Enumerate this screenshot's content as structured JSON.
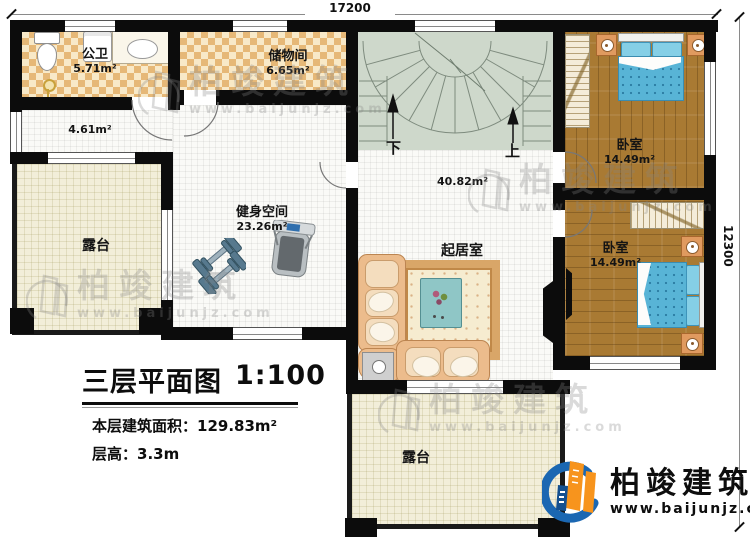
{
  "dimensions": {
    "top": "17200",
    "right": "12300"
  },
  "rooms": {
    "bathroom": {
      "name": "公卫",
      "area": "5.71m²"
    },
    "storage": {
      "name": "储物间",
      "area": "6.65m²"
    },
    "hall": {
      "area": "4.61m²"
    },
    "gym": {
      "name": "健身空间",
      "area": "23.26m²"
    },
    "living": {
      "name": "起居室",
      "area": "40.82m²"
    },
    "bedroom_top": {
      "name": "卧室",
      "area": "14.49m²"
    },
    "bedroom_bottom": {
      "name": "卧室",
      "area": "14.49m²"
    },
    "terrace_left": {
      "name": "露台"
    },
    "terrace_bottom": {
      "name": "露台"
    }
  },
  "stairs": {
    "down": "下",
    "up": "上"
  },
  "title_block": {
    "title": "三层平面图",
    "scale": "1:100",
    "area_label": "本层建筑面积：",
    "area_value": "129.83m²",
    "height_label": "层高：",
    "height_value": "3.3m"
  },
  "branding": {
    "name": "柏竣建筑",
    "url": "www.baijunjz.com",
    "colors": {
      "blue": "#1b67b2",
      "orange": "#f7941d",
      "wall": "#0c0c0c",
      "bed": "#58b4d6"
    }
  },
  "watermark": {
    "name": "柏竣建筑",
    "url": "www.baijunjz.com"
  }
}
